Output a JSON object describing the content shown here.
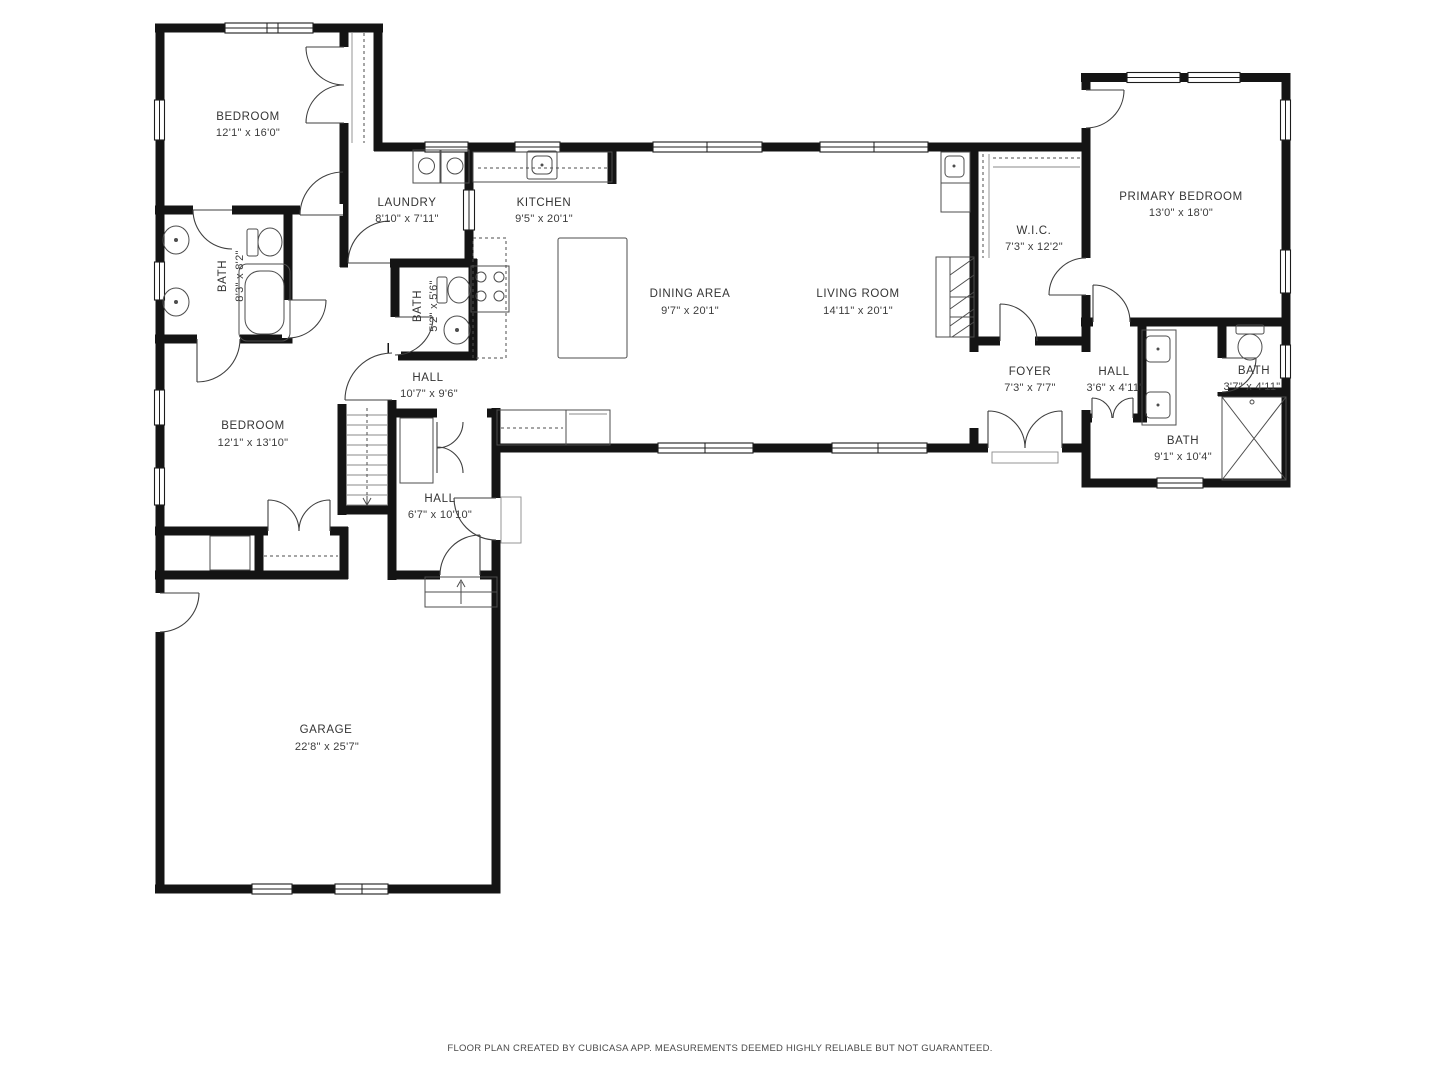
{
  "floorplan": {
    "footer": "FLOOR PLAN CREATED BY CUBICASA APP. MEASUREMENTS DEEMED HIGHLY RELIABLE BUT NOT GUARANTEED.",
    "colors": {
      "wall": "#141414",
      "fixture": "#4d4d4d",
      "label": "#343434",
      "background": "#ffffff"
    },
    "rooms": [
      {
        "id": "bedroom-1",
        "name": "BEDROOM",
        "dims": "12'1\" x 16'0\""
      },
      {
        "id": "laundry",
        "name": "LAUNDRY",
        "dims": "8'10\" x 7'11\""
      },
      {
        "id": "kitchen",
        "name": "KITCHEN",
        "dims": "9'5\" x 20'1\""
      },
      {
        "id": "bath-left",
        "name": "BATH",
        "dims": "8'3\" x 8'2\""
      },
      {
        "id": "bath-kitchen",
        "name": "BATH",
        "dims": "5'2\" x 5'6\""
      },
      {
        "id": "dining-area",
        "name": "DINING AREA",
        "dims": "9'7\" x 20'1\""
      },
      {
        "id": "living-room",
        "name": "LIVING ROOM",
        "dims": "14'11\" x 20'1\""
      },
      {
        "id": "wic",
        "name": "W.I.C.",
        "dims": "7'3\" x 12'2\""
      },
      {
        "id": "primary-bedroom",
        "name": "PRIMARY BEDROOM",
        "dims": "13'0\" x 18'0\""
      },
      {
        "id": "hall-center",
        "name": "HALL",
        "dims": "10'7\" x 9'6\""
      },
      {
        "id": "bedroom-2",
        "name": "BEDROOM",
        "dims": "12'1\" x 13'10\""
      },
      {
        "id": "foyer",
        "name": "FOYER",
        "dims": "7'3\" x 7'7\""
      },
      {
        "id": "hall-right",
        "name": "HALL",
        "dims": "3'6\" x 4'11\""
      },
      {
        "id": "bath-small",
        "name": "BATH",
        "dims": "3'7\" x 4'11\""
      },
      {
        "id": "bath-primary",
        "name": "BATH",
        "dims": "9'1\" x 10'4\""
      },
      {
        "id": "hall-lower",
        "name": "HALL",
        "dims": "6'7\" x 10'10\""
      },
      {
        "id": "garage",
        "name": "GARAGE",
        "dims": "22'8\" x 25'7\""
      }
    ]
  }
}
